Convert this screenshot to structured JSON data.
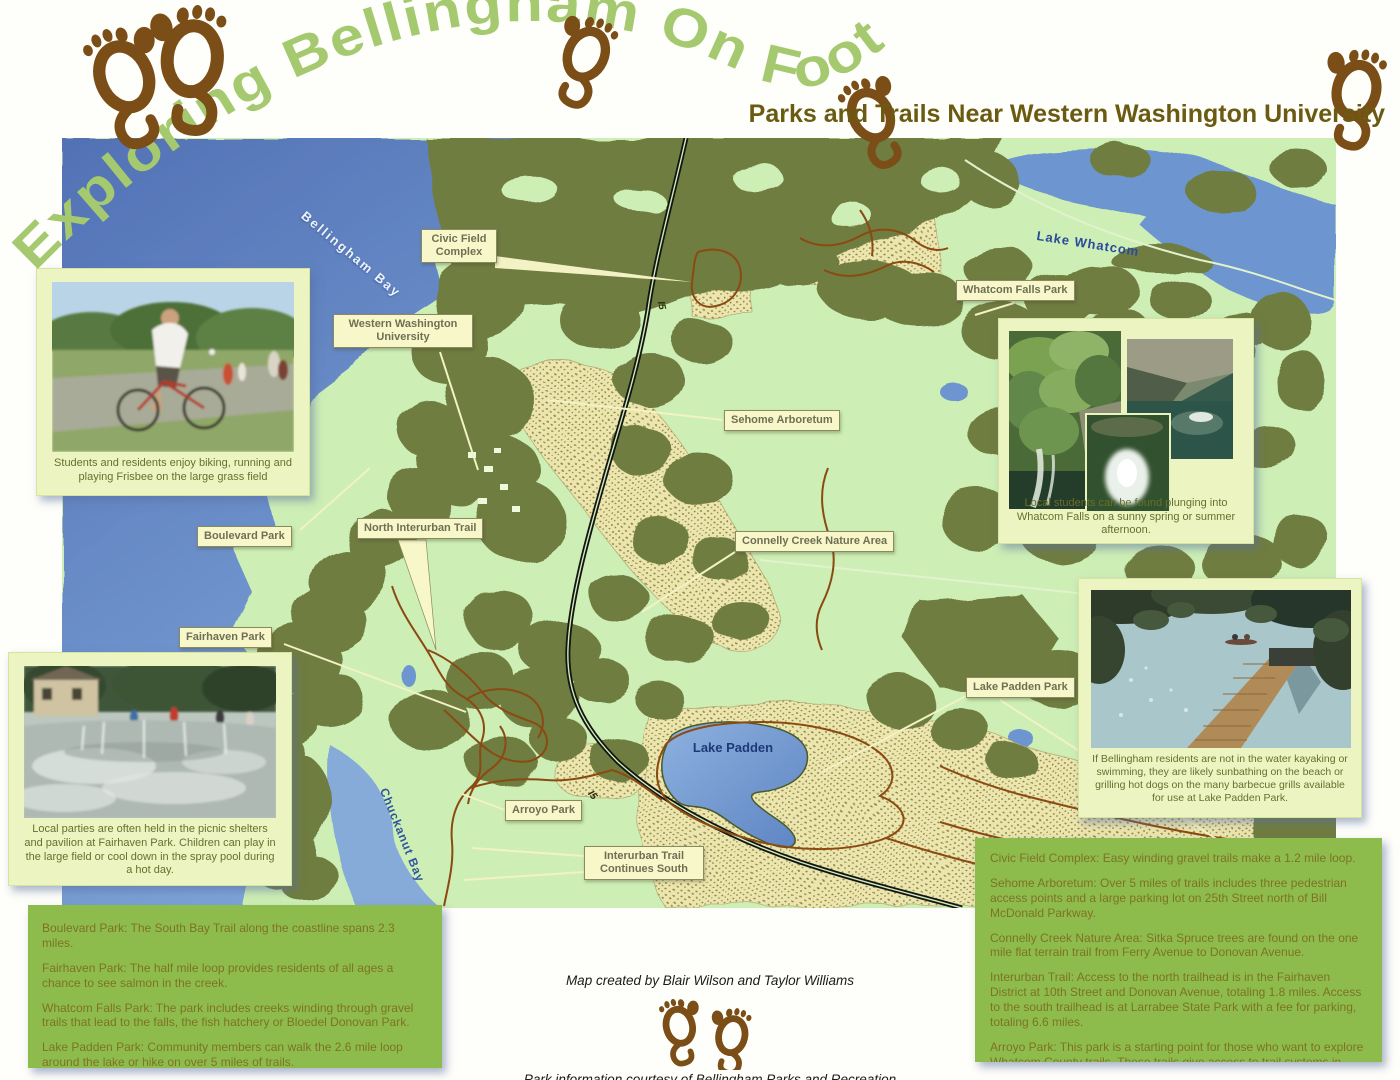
{
  "poster": {
    "title_arc": "Exploring Bellingham On Foot",
    "subtitle": "Parks and Trails Near Western Washington University"
  },
  "map": {
    "place_labels": [
      {
        "text": "Civic Field Complex"
      },
      {
        "text": "Western Washington University"
      },
      {
        "text": "Sehome Arboretum"
      },
      {
        "text": "Whatcom Falls Park"
      },
      {
        "text": "Boulevard Park"
      },
      {
        "text": "North Interurban Trail"
      },
      {
        "text": "Connelly Creek Nature Area"
      },
      {
        "text": "Fairhaven Park"
      },
      {
        "text": "Lake Padden Park"
      },
      {
        "text": "Arroyo Park"
      },
      {
        "text": "Interurban Trail Continues South"
      }
    ],
    "water_labels": {
      "bellingham_bay": "Bellingham Bay",
      "lake_whatcom": "Lake Whatcom",
      "chuckanut_bay": "Chuckanut Bay",
      "lake_padden": "Lake Padden"
    },
    "highway_label": "I5"
  },
  "photos": {
    "biking": {
      "caption": "Students and residents enjoy biking, running and playing Frisbee on the large grass field"
    },
    "spray_pool": {
      "caption": "Local parties are often held in the picnic shelters and pavilion at Fairhaven Park. Children can play in the large field or cool down in the spray pool during a hot day."
    },
    "whatcom_falls": {
      "caption": "Local students can be found plunging into Whatcom Falls on a sunny spring or summer afternoon."
    },
    "lake_padden": {
      "caption": "If Bellingham residents are not in the water kayaking or swimming, they are likely sunbathing on the beach or grilling hot dogs on the many barbecue grills available for use at Lake Padden Park."
    }
  },
  "info_left": {
    "paragraphs": [
      "Boulevard Park: The South Bay Trail along the coastline spans 2.3 miles.",
      "Fairhaven Park: The half mile loop provides residents of all ages a chance to see salmon in the creek.",
      "Whatcom Falls Park: The park includes creeks winding through gravel trails that lead to the falls, the fish hatchery or Bloedel Donovan Park.",
      "Lake Padden Park: Community members can walk the 2.6 mile loop around the lake or hike on over 5 miles of trails."
    ]
  },
  "info_right": {
    "paragraphs": [
      "Civic Field Complex: Easy winding gravel trails make a 1.2 mile loop.",
      "Sehome Arboretum: Over 5 miles of trails includes three pedestrian access points and a large parking lot on 25th Street north of Bill McDonald Parkway.",
      "Connelly Creek Nature Area: Sitka Spruce trees are found on the one mile flat terrain trail from Ferry Avenue to Donovan Avenue.",
      "Interurban Trail: Access to the north trailhead is in the Fairhaven District at 10th Street and Donovan Avenue, totaling 1.8 miles. Access to the south trailhead is at Larrabee State Park with a fee for parking, totaling 6.6 miles.",
      "Arroyo Park: This park is a starting point for those who want to explore Whatcom County trails. These trails give access to trail systems in Larrabee State Park up through the Chuckanut Mountains."
    ]
  },
  "credits": {
    "created_by": "Map created by Blair Wilson and Taylor Williams",
    "courtesy": "Park information courtesy of Bellingham Parks and Recreation"
  },
  "colors": {
    "title_green": "#a5c96f",
    "footprint_brown": "#7a4e16",
    "subtitle_brown": "#6a5a12",
    "water_blue": "#5f80c0",
    "land_green": "#cdeeb5",
    "forest_olive": "#6f7d41",
    "trail_brown": "#8a4a12",
    "info_box_green": "#8ebc4c",
    "label_box_cream": "#f7f7c9"
  }
}
